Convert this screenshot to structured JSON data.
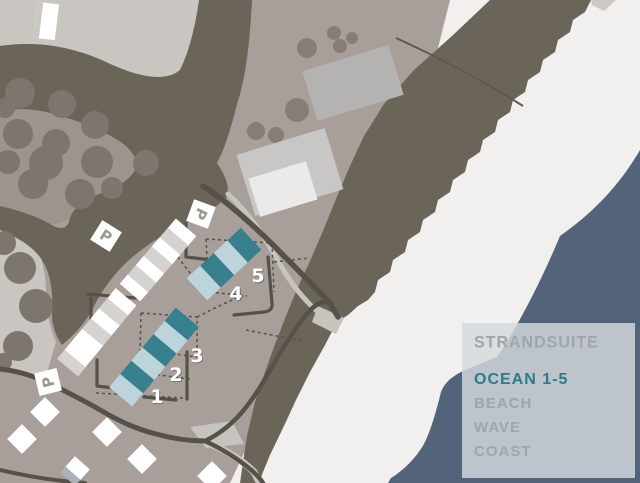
{
  "legend": {
    "title": "STRANDSUITE",
    "items": [
      {
        "label": "OCEAN 1-5",
        "highlighted": true
      },
      {
        "label": "BEACH",
        "highlighted": false
      },
      {
        "label": "WAVE",
        "highlighted": false
      },
      {
        "label": "COAST",
        "highlighted": false
      }
    ]
  },
  "map": {
    "units": [
      {
        "label": "1"
      },
      {
        "label": "2"
      },
      {
        "label": "3"
      },
      {
        "label": "4"
      },
      {
        "label": "5"
      }
    ],
    "parking_signs": [
      {
        "label": "P"
      },
      {
        "label": "P"
      },
      {
        "label": "P"
      }
    ],
    "colors": {
      "land": "#a89f9a",
      "light_field": "#c9c5c1",
      "orchard": "#9c948d",
      "vegetation_dune": "#6a6459",
      "beach": "#f1f0ee",
      "ocean": "#536379",
      "road": "#565149",
      "unit_dark": "#39808e",
      "unit_light": "#bcd4da",
      "legend_text": "#a0a5a9",
      "legend_highlight": "#2d7b88"
    }
  }
}
